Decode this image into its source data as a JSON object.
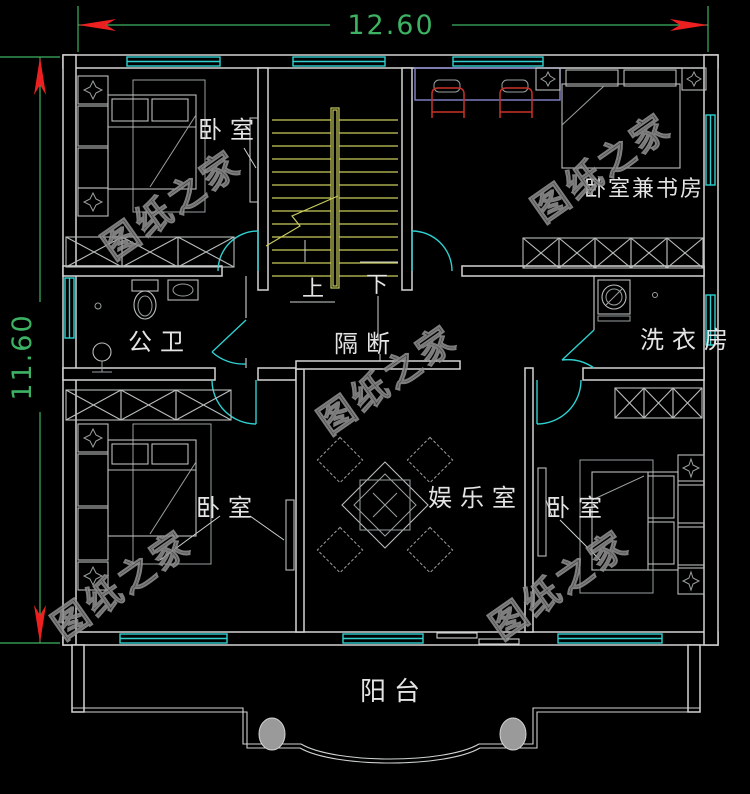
{
  "dimensions": {
    "top": "12.60",
    "left": "11.60"
  },
  "labels": {
    "bedroom_top_left": "卧室",
    "bedroom_study": "卧室兼书房",
    "bathroom": "公卫",
    "partition": "隔断",
    "laundry": "洗衣房",
    "entertainment": "娱乐室",
    "bedroom_bottom_left": "卧室",
    "bedroom_bottom_right": "卧室",
    "balcony": "阳台",
    "stairs_up": "上",
    "stairs_down": "下"
  },
  "watermark": {
    "text": "图纸之家"
  },
  "colors": {
    "background": "#000000",
    "walls": "#d4d4d4",
    "windows_doors": "#2fd0d0",
    "stairs": "#c9cc5e",
    "dimension_lines": "#3db263",
    "dimension_arrows": "#ec2020",
    "chairs": "#c83228",
    "desk": "#8585cd",
    "room_text": "#e4e4e4",
    "watermark": "#909090"
  }
}
